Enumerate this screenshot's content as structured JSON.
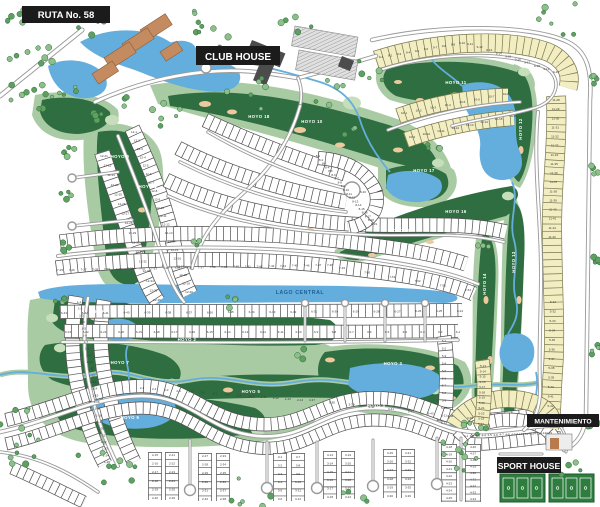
{
  "map_title_labels": {
    "route": "RUTA No. 58",
    "club_house": "CLUB HOUSE",
    "central_lake": "LAGO CENTRAL",
    "maintenance": "MANTENIMIENTO",
    "sport_house": "SPORT HOUSE"
  },
  "holes": [
    [
      "HOYO 1",
      148,
      188,
      0
    ],
    [
      "HOYO 2",
      187,
      341,
      0
    ],
    [
      "HOYO 3",
      393,
      365,
      0
    ],
    [
      "HOYO 4",
      376,
      407,
      0
    ],
    [
      "HOYO 5",
      251,
      393,
      0
    ],
    [
      "HOYO 6",
      130,
      419,
      0
    ],
    [
      "HOYO 7",
      120,
      364,
      0
    ],
    [
      "HOYO 8",
      99,
      313,
      0
    ],
    [
      "HOYO 9",
      120,
      158,
      0
    ],
    [
      "HOYO 10",
      312,
      123,
      0
    ],
    [
      "HOYO 11",
      456,
      84,
      0
    ],
    [
      "HOYO 12",
      522,
      129,
      -90
    ],
    [
      "HOYO 13",
      515,
      262,
      -90
    ],
    [
      "HOYO 14",
      486,
      284,
      -90
    ],
    [
      "HOYO 15",
      400,
      232,
      0
    ],
    [
      "HOYO 16",
      456,
      213,
      0
    ],
    [
      "HOYO 17",
      424,
      172,
      0
    ],
    [
      "HOYO 18",
      259,
      118,
      0
    ]
  ],
  "lot_rows": [
    [
      "1",
      1,
      25,
      79,
      302,
      107,
      462
    ],
    [
      "12",
      1,
      20,
      134,
      132,
      189,
      292
    ],
    [
      "12",
      21,
      36,
      104,
      156,
      157,
      300
    ],
    [
      "7",
      25,
      48,
      60,
      270,
      330,
      265
    ],
    [
      "7",
      49,
      54,
      342,
      268,
      468,
      290
    ],
    [
      "6",
      43,
      24,
      64,
      313,
      460,
      311
    ],
    [
      "6",
      23,
      1,
      68,
      332,
      458,
      332
    ],
    [
      "8",
      1,
      19,
      318,
      156,
      374,
      224
    ],
    [
      "8",
      20,
      20,
      363,
      192,
      363,
      192
    ],
    [
      "2",
      1,
      14,
      142,
      388,
      300,
      400
    ],
    [
      "2",
      15,
      20,
      155,
      455,
      155,
      498
    ],
    [
      "2",
      21,
      26,
      172,
      455,
      172,
      498
    ],
    [
      "2",
      27,
      32,
      205,
      456,
      205,
      499
    ],
    [
      "2",
      33,
      38,
      223,
      456,
      223,
      499
    ],
    [
      "3",
      1,
      6,
      280,
      457,
      280,
      499
    ],
    [
      "3",
      7,
      12,
      298,
      457,
      298,
      499
    ],
    [
      "3",
      13,
      18,
      330,
      455,
      330,
      497
    ],
    [
      "3",
      19,
      24,
      348,
      455,
      348,
      497
    ],
    [
      "3",
      25,
      30,
      390,
      453,
      390,
      496
    ],
    [
      "3",
      31,
      36,
      408,
      453,
      408,
      496
    ],
    [
      "3",
      37,
      45,
      312,
      400,
      470,
      418
    ],
    [
      "4",
      1,
      15,
      466,
      436,
      549,
      433
    ],
    [
      "4",
      18,
      25,
      449,
      447,
      449,
      498
    ],
    [
      "4",
      26,
      34,
      473,
      447,
      473,
      499
    ],
    [
      "5",
      1,
      12,
      444,
      341,
      444,
      423
    ],
    [
      "5",
      13,
      24,
      483,
      366,
      481,
      424
    ],
    [
      "5",
      31,
      44,
      553,
      302,
      550,
      425
    ],
    [
      "9",
      1,
      10,
      381,
      57,
      462,
      43
    ],
    [
      "9",
      11,
      20,
      470,
      44,
      556,
      72
    ],
    [
      "10",
      1,
      8,
      404,
      113,
      506,
      94
    ],
    [
      "10",
      9,
      16,
      412,
      137,
      513,
      116
    ],
    [
      "11",
      28,
      43,
      556,
      100,
      552,
      237
    ]
  ],
  "colors": {
    "fairway_dark": "#2f6e41",
    "fairway_light": "#a9cba3",
    "green_highlight": "#c6dfba",
    "water": "#64aedd",
    "water_label": "#1f5f93",
    "lot_fill_white": "#ffffff",
    "lot_fill_yellow": "#f3edc2",
    "lot_line": "#4d4d4d",
    "lot_line_yellow": "#77774e",
    "road_casing": "#999999",
    "road_fill": "#ffffff",
    "label_bg": "#1b1b1b",
    "label_text": "#ffffff",
    "sand": "#ecca9e",
    "tennis_court": "#c48b60",
    "building": "#4c4c4c",
    "parking": "#e0e0e0",
    "sport_court": "#2e7d3f",
    "tree_fill": "#8cbf8a",
    "tree_stroke": "#2f6b3c",
    "hole_label": "#ffffff",
    "lot_number": "#3a3a3a"
  }
}
